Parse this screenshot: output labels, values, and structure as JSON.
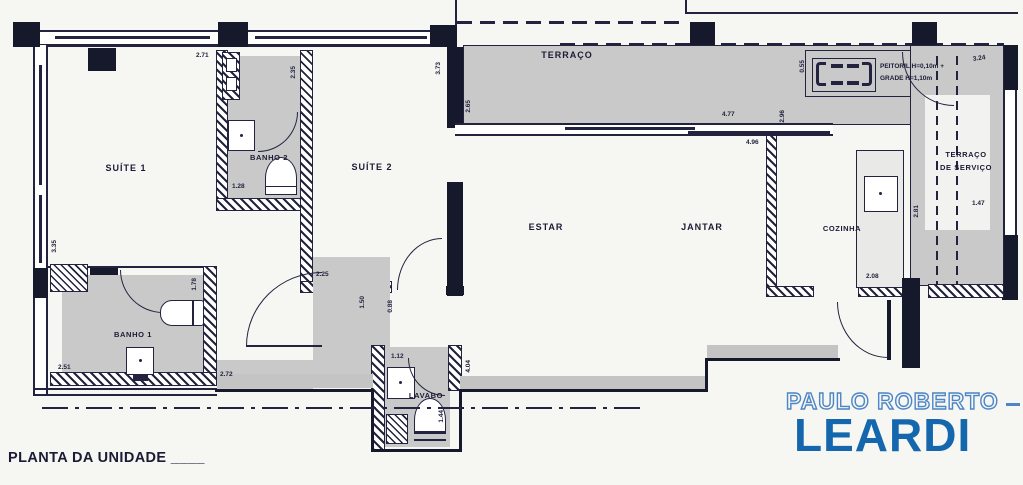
{
  "rooms": {
    "suite1": {
      "label": "SUÍTE 1"
    },
    "banho2": {
      "label": "BANHO 2"
    },
    "suite2": {
      "label": "SUÍTE 2"
    },
    "terraco": {
      "label": "TERRAÇO"
    },
    "estar": {
      "label": "ESTAR"
    },
    "jantar": {
      "label": "JANTAR"
    },
    "cozinha": {
      "label": "COZINHA"
    },
    "terraco_servico": {
      "label_line1": "TERRAÇO",
      "label_line2": "DE SERVIÇO"
    },
    "banho1": {
      "label": "BANHO 1"
    },
    "lavabo": {
      "label": "LAVABO"
    }
  },
  "dimensions": {
    "suite1_top": "2.71",
    "suite1_left": "3.35",
    "banho2_right": "2.35",
    "banho2_bottom": "1.28",
    "suite2_right": "3.73",
    "suite2_bottom": "2.25",
    "terraco_left": "2.65",
    "terraco_right": "4.77",
    "estar_top": "4.96",
    "cozinha_top_left": "2.96",
    "cozinha_bottom": "2.08",
    "kitchen_window_left": "0.55",
    "service_top": "3.24",
    "service_bottom": "1.47",
    "service_left": "2.81",
    "banho1_bottom": "2.51",
    "banho1_right": "1.78",
    "hall_bottom": "2.72",
    "hall_door_a": "1.50",
    "hall_door_b": "0.88",
    "lavabo_top": "1.12",
    "lavabo_inner": "1.44",
    "hall_right": "4.04"
  },
  "notes": {
    "window_note_line1": "PEITORIL H=0,10m +",
    "window_note_line2": "GRADE H=1,10m"
  },
  "footer": {
    "caption": "PLANTA DA UNIDADE ____"
  },
  "logo": {
    "top": "PAULO ROBERTO",
    "bottom": "LEARDI"
  },
  "colors": {
    "line": "#23233f",
    "wall_black": "#16182c",
    "floor_gray": "#c9c9c9",
    "logo_outline_blue": "#4c86c6",
    "logo_solid_blue": "#1467ad",
    "background": "#f6f6f3"
  }
}
